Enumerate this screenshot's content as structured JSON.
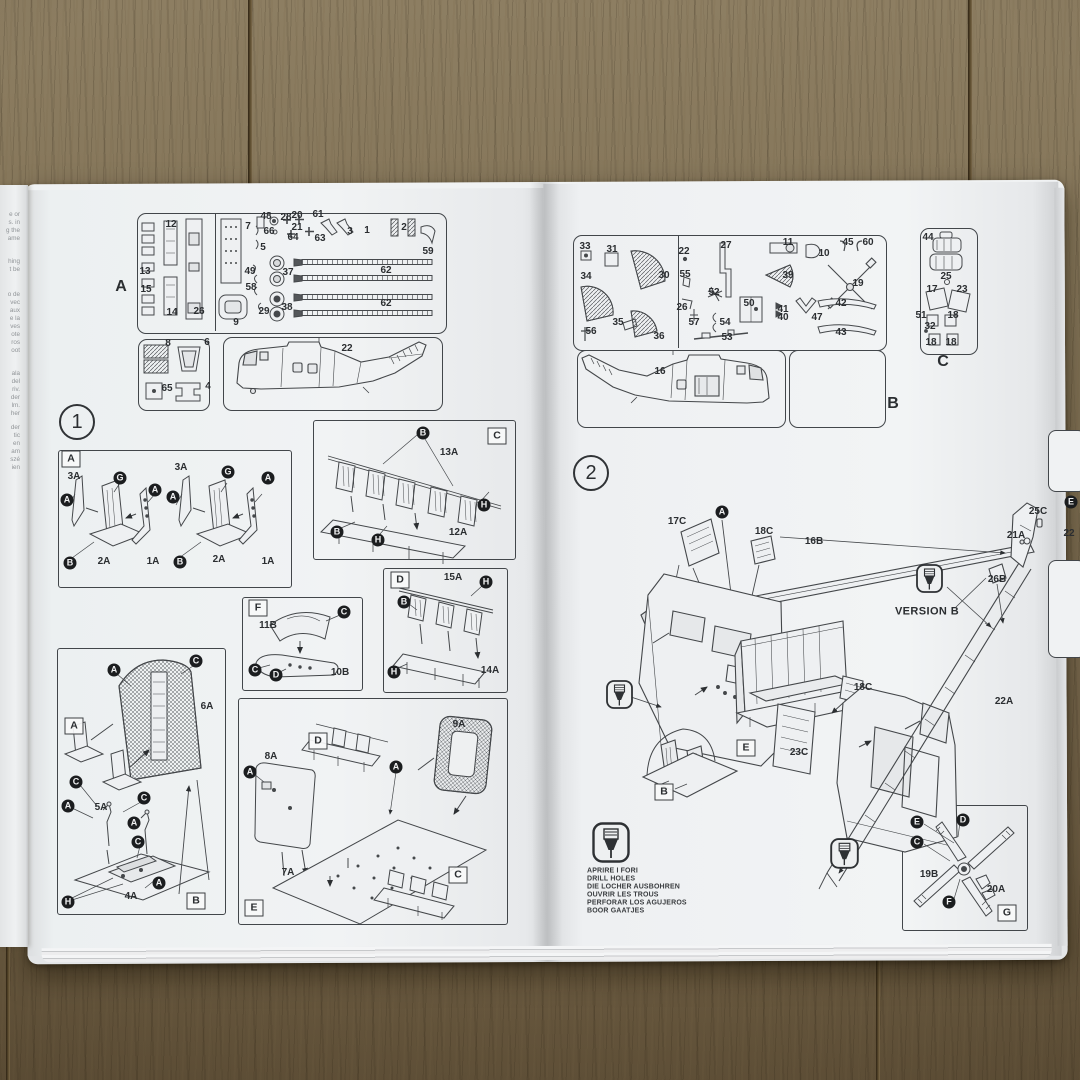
{
  "photo": {
    "wood_color": "#7e6f53",
    "paper_color": "#eef0f2",
    "ink_color": "#33363a"
  },
  "left_margin_text": {
    "fragments": [
      {
        "t": "e or",
        "k": "frag",
        "x": 20,
        "y": 215
      },
      {
        "t": "s. in",
        "k": "frag",
        "x": 20,
        "y": 223
      },
      {
        "t": "g the",
        "k": "frag",
        "x": 20,
        "y": 231
      },
      {
        "t": "ame",
        "k": "frag",
        "x": 20,
        "y": 239
      },
      {
        "t": "hing",
        "k": "frag",
        "x": 20,
        "y": 262
      },
      {
        "t": "t be",
        "k": "frag",
        "x": 20,
        "y": 270
      },
      {
        "t": "o de",
        "k": "frag",
        "x": 20,
        "y": 295
      },
      {
        "t": "vec",
        "k": "frag",
        "x": 20,
        "y": 303
      },
      {
        "t": "aux",
        "k": "frag",
        "x": 20,
        "y": 311
      },
      {
        "t": "e la",
        "k": "frag",
        "x": 20,
        "y": 319
      },
      {
        "t": "ves",
        "k": "frag",
        "x": 20,
        "y": 327
      },
      {
        "t": "ote",
        "k": "frag",
        "x": 20,
        "y": 335
      },
      {
        "t": "ros",
        "k": "frag",
        "x": 20,
        "y": 343
      },
      {
        "t": "oot",
        "k": "frag",
        "x": 20,
        "y": 351
      },
      {
        "t": "ala",
        "k": "frag",
        "x": 20,
        "y": 374
      },
      {
        "t": "del",
        "k": "frag",
        "x": 20,
        "y": 382
      },
      {
        "t": "riv.",
        "k": "frag",
        "x": 20,
        "y": 390
      },
      {
        "t": "der",
        "k": "frag",
        "x": 20,
        "y": 398
      },
      {
        "t": "lm.",
        "k": "frag",
        "x": 20,
        "y": 406
      },
      {
        "t": "her",
        "k": "frag",
        "x": 20,
        "y": 414
      },
      {
        "t": "der",
        "k": "frag",
        "x": 20,
        "y": 428
      },
      {
        "t": "tic",
        "k": "frag",
        "x": 20,
        "y": 436
      },
      {
        "t": "en",
        "k": "frag",
        "x": 20,
        "y": 444
      },
      {
        "t": "am",
        "k": "frag",
        "x": 20,
        "y": 452
      },
      {
        "t": "szé",
        "k": "frag",
        "x": 20,
        "y": 460
      },
      {
        "t": "ien",
        "k": "frag",
        "x": 20,
        "y": 468
      }
    ]
  },
  "left_page": {
    "sprue_panel": {
      "sheet_letter": "A",
      "labels": [
        {
          "t": "A",
          "k": "b",
          "x": 121,
          "y": 287
        },
        {
          "t": "12",
          "x": 171,
          "y": 225
        },
        {
          "t": "13",
          "x": 145,
          "y": 272
        },
        {
          "t": "15",
          "x": 146,
          "y": 290
        },
        {
          "t": "14",
          "x": 172,
          "y": 313
        },
        {
          "t": "26",
          "x": 199,
          "y": 312
        },
        {
          "t": "7",
          "x": 248,
          "y": 227
        },
        {
          "t": "48",
          "x": 266,
          "y": 217
        },
        {
          "t": "28",
          "x": 286,
          "y": 218
        },
        {
          "t": "20",
          "x": 297,
          "y": 216
        },
        {
          "t": "61",
          "x": 318,
          "y": 215
        },
        {
          "t": "66",
          "x": 269,
          "y": 232
        },
        {
          "t": "21",
          "x": 297,
          "y": 228
        },
        {
          "t": "64",
          "x": 293,
          "y": 238
        },
        {
          "t": "63",
          "x": 320,
          "y": 239
        },
        {
          "t": "3",
          "x": 350,
          "y": 232
        },
        {
          "t": "1",
          "x": 367,
          "y": 231
        },
        {
          "t": "2",
          "x": 404,
          "y": 228
        },
        {
          "t": "59",
          "x": 428,
          "y": 252
        },
        {
          "t": "5",
          "x": 263,
          "y": 248
        },
        {
          "t": "49",
          "x": 250,
          "y": 272
        },
        {
          "t": "37",
          "x": 288,
          "y": 273
        },
        {
          "t": "58",
          "x": 251,
          "y": 288
        },
        {
          "t": "38",
          "x": 287,
          "y": 308
        },
        {
          "t": "29",
          "x": 264,
          "y": 312
        },
        {
          "t": "9",
          "x": 236,
          "y": 323
        },
        {
          "t": "62",
          "x": 386,
          "y": 271
        },
        {
          "t": "62",
          "x": 386,
          "y": 304
        },
        {
          "t": "8",
          "x": 168,
          "y": 344
        },
        {
          "t": "6",
          "x": 207,
          "y": 343
        },
        {
          "t": "65",
          "x": 167,
          "y": 389
        },
        {
          "t": "4",
          "x": 208,
          "y": 387
        },
        {
          "t": "22",
          "x": 347,
          "y": 349
        }
      ]
    },
    "step1": {
      "labels": [
        {
          "t": "1",
          "k": "step",
          "x": 77,
          "y": 422
        }
      ]
    },
    "sections": {
      "a": {
        "labels": [
          {
            "t": "A",
            "k": "s",
            "x": 71,
            "y": 459
          },
          {
            "t": "3A",
            "x": 74,
            "y": 477
          },
          {
            "t": "A",
            "k": "c",
            "x": 67,
            "y": 500
          },
          {
            "t": "G",
            "k": "c",
            "x": 120,
            "y": 478
          },
          {
            "t": "A",
            "k": "c",
            "x": 155,
            "y": 490
          },
          {
            "t": "B",
            "k": "c",
            "x": 70,
            "y": 563
          },
          {
            "t": "2A",
            "x": 104,
            "y": 562
          },
          {
            "t": "1A",
            "x": 153,
            "y": 562
          },
          {
            "t": "3A",
            "x": 181,
            "y": 468
          },
          {
            "t": "A",
            "k": "c",
            "x": 173,
            "y": 497
          },
          {
            "t": "G",
            "k": "c",
            "x": 228,
            "y": 472
          },
          {
            "t": "A",
            "k": "c",
            "x": 268,
            "y": 478
          },
          {
            "t": "B",
            "k": "c",
            "x": 180,
            "y": 562
          },
          {
            "t": "2A",
            "x": 219,
            "y": 560
          },
          {
            "t": "1A",
            "x": 268,
            "y": 562
          }
        ]
      },
      "c": {
        "labels": [
          {
            "t": "C",
            "k": "s",
            "x": 497,
            "y": 436
          },
          {
            "t": "B",
            "k": "c",
            "x": 423,
            "y": 433
          },
          {
            "t": "13A",
            "x": 449,
            "y": 453
          },
          {
            "t": "H",
            "k": "c",
            "x": 484,
            "y": 505
          },
          {
            "t": "B",
            "k": "c",
            "x": 337,
            "y": 532
          },
          {
            "t": "H",
            "k": "c",
            "x": 378,
            "y": 540
          },
          {
            "t": "12A",
            "x": 458,
            "y": 533
          }
        ]
      },
      "f": {
        "labels": [
          {
            "t": "F",
            "k": "s",
            "x": 258,
            "y": 608
          },
          {
            "t": "11B",
            "x": 268,
            "y": 626
          },
          {
            "t": "C",
            "k": "c",
            "x": 344,
            "y": 612
          },
          {
            "t": "C",
            "k": "c",
            "x": 255,
            "y": 670
          },
          {
            "t": "D",
            "k": "c",
            "x": 276,
            "y": 675
          },
          {
            "t": "10B",
            "x": 340,
            "y": 673
          }
        ]
      },
      "d": {
        "labels": [
          {
            "t": "D",
            "k": "s",
            "x": 400,
            "y": 580
          },
          {
            "t": "15A",
            "x": 453,
            "y": 578
          },
          {
            "t": "H",
            "k": "c",
            "x": 486,
            "y": 582
          },
          {
            "t": "B",
            "k": "c",
            "x": 404,
            "y": 602
          },
          {
            "t": "H",
            "k": "c",
            "x": 394,
            "y": 672
          },
          {
            "t": "14A",
            "x": 490,
            "y": 671
          }
        ]
      },
      "b": {
        "labels": [
          {
            "t": "A",
            "k": "s",
            "x": 74,
            "y": 726
          },
          {
            "t": "A",
            "k": "c",
            "x": 114,
            "y": 670
          },
          {
            "t": "C",
            "k": "c",
            "x": 196,
            "y": 661
          },
          {
            "t": "6A",
            "x": 207,
            "y": 707
          },
          {
            "t": "C",
            "k": "c",
            "x": 76,
            "y": 782
          },
          {
            "t": "A",
            "k": "c",
            "x": 68,
            "y": 806
          },
          {
            "t": "5A",
            "x": 101,
            "y": 808
          },
          {
            "t": "C",
            "k": "c",
            "x": 144,
            "y": 798
          },
          {
            "t": "A",
            "k": "c",
            "x": 134,
            "y": 823
          },
          {
            "t": "C",
            "k": "c",
            "x": 138,
            "y": 842
          },
          {
            "t": "A",
            "k": "c",
            "x": 159,
            "y": 883
          },
          {
            "t": "4A",
            "x": 131,
            "y": 897
          },
          {
            "t": "H",
            "k": "c",
            "x": 68,
            "y": 902
          },
          {
            "t": "B",
            "k": "s",
            "x": 196,
            "y": 901
          }
        ]
      },
      "e": {
        "labels": [
          {
            "t": "D",
            "k": "s",
            "x": 318,
            "y": 741
          },
          {
            "t": "9A",
            "x": 459,
            "y": 725
          },
          {
            "t": "8A",
            "x": 271,
            "y": 757
          },
          {
            "t": "A",
            "k": "c",
            "x": 250,
            "y": 772
          },
          {
            "t": "A",
            "k": "c",
            "x": 396,
            "y": 767
          },
          {
            "t": "7A",
            "x": 288,
            "y": 873
          },
          {
            "t": "C",
            "k": "s",
            "x": 458,
            "y": 875
          },
          {
            "t": "E",
            "k": "s",
            "x": 254,
            "y": 908
          }
        ]
      }
    }
  },
  "right_page": {
    "sprue_panel_b": {
      "sheet_letter": "B",
      "labels": [
        {
          "t": "B",
          "k": "b",
          "x": 893,
          "y": 404
        },
        {
          "t": "33",
          "x": 585,
          "y": 247
        },
        {
          "t": "31",
          "x": 612,
          "y": 250
        },
        {
          "t": "30",
          "x": 664,
          "y": 276
        },
        {
          "t": "34",
          "x": 586,
          "y": 277
        },
        {
          "t": "35",
          "x": 618,
          "y": 323
        },
        {
          "t": "56",
          "x": 591,
          "y": 332
        },
        {
          "t": "36",
          "x": 659,
          "y": 337
        },
        {
          "t": "22",
          "x": 684,
          "y": 252
        },
        {
          "t": "27",
          "x": 726,
          "y": 246
        },
        {
          "t": "55",
          "x": 685,
          "y": 275
        },
        {
          "t": "52",
          "x": 714,
          "y": 293
        },
        {
          "t": "26",
          "x": 682,
          "y": 308
        },
        {
          "t": "57",
          "x": 694,
          "y": 323
        },
        {
          "t": "54",
          "x": 725,
          "y": 323
        },
        {
          "t": "53",
          "x": 727,
          "y": 338
        },
        {
          "t": "50",
          "x": 749,
          "y": 304
        },
        {
          "t": "11",
          "x": 788,
          "y": 243
        },
        {
          "t": "10",
          "x": 824,
          "y": 254
        },
        {
          "t": "39",
          "x": 788,
          "y": 276
        },
        {
          "t": "41",
          "x": 783,
          "y": 310
        },
        {
          "t": "40",
          "x": 783,
          "y": 318
        },
        {
          "t": "47",
          "x": 817,
          "y": 318
        },
        {
          "t": "19",
          "x": 858,
          "y": 284
        },
        {
          "t": "45",
          "x": 848,
          "y": 243
        },
        {
          "t": "60",
          "x": 868,
          "y": 243
        },
        {
          "t": "42",
          "x": 841,
          "y": 304
        },
        {
          "t": "43",
          "x": 841,
          "y": 333
        },
        {
          "t": "16",
          "x": 660,
          "y": 372
        }
      ]
    },
    "sprue_panel_c": {
      "sheet_letter": "C",
      "labels": [
        {
          "t": "C",
          "k": "b",
          "x": 943,
          "y": 362
        },
        {
          "t": "44",
          "x": 928,
          "y": 238
        },
        {
          "t": "25",
          "x": 946,
          "y": 277
        },
        {
          "t": "17",
          "x": 932,
          "y": 290
        },
        {
          "t": "23",
          "x": 962,
          "y": 290
        },
        {
          "t": "51",
          "x": 921,
          "y": 316
        },
        {
          "t": "18",
          "x": 953,
          "y": 316
        },
        {
          "t": "32",
          "x": 930,
          "y": 327
        },
        {
          "t": "18",
          "x": 931,
          "y": 343
        },
        {
          "t": "18",
          "x": 951,
          "y": 343
        }
      ]
    },
    "step2": {
      "version_note": "VERSION B",
      "labels": [
        {
          "t": "2",
          "k": "step",
          "x": 591,
          "y": 473
        },
        {
          "t": "17C",
          "x": 677,
          "y": 522
        },
        {
          "t": "A",
          "k": "c",
          "x": 722,
          "y": 512
        },
        {
          "t": "18C",
          "x": 764,
          "y": 532
        },
        {
          "t": "16B",
          "x": 814,
          "y": 542
        },
        {
          "t": "25C",
          "x": 1038,
          "y": 512
        },
        {
          "t": "21A",
          "x": 1016,
          "y": 536
        },
        {
          "t": "26B",
          "x": 997,
          "y": 580
        },
        {
          "t": "VERSION B",
          "k": "v",
          "x": 927,
          "y": 612
        },
        {
          "t": "18C",
          "x": 863,
          "y": 688
        },
        {
          "t": "23C",
          "x": 799,
          "y": 753
        },
        {
          "t": "E",
          "k": "s",
          "x": 746,
          "y": 748
        },
        {
          "t": "B",
          "k": "s",
          "x": 664,
          "y": 792
        },
        {
          "t": "22A",
          "x": 1004,
          "y": 702
        },
        {
          "t": "E",
          "k": "c",
          "x": 1071,
          "y": 502
        },
        {
          "t": "22",
          "x": 1069,
          "y": 534
        }
      ]
    },
    "drill_legend": {
      "lines": [
        "APRIRE I FORI",
        "DRILL HOLES",
        "DIE LOCHER AUSBOHREN",
        "OUVRIR LES TROUS",
        "PERFORAR LOS AGUJEROS",
        "BOOR GAATJES"
      ],
      "labels": [
        {
          "t": "APRIRE I FORI",
          "k": "dl",
          "x": 587,
          "y": 871
        },
        {
          "t": "DRILL HOLES",
          "k": "dl",
          "x": 587,
          "y": 879
        },
        {
          "t": "DIE LOCHER AUSBOHREN",
          "k": "dl",
          "x": 587,
          "y": 887
        },
        {
          "t": "OUVRIR LES TROUS",
          "k": "dl",
          "x": 587,
          "y": 895
        },
        {
          "t": "PERFORAR LOS AGUJEROS",
          "k": "dl",
          "x": 587,
          "y": 903
        },
        {
          "t": "BOOR GAATJES",
          "k": "dl",
          "x": 587,
          "y": 911
        }
      ]
    },
    "section_g": {
      "labels": [
        {
          "t": "E",
          "k": "c",
          "x": 917,
          "y": 822
        },
        {
          "t": "D",
          "k": "c",
          "x": 963,
          "y": 820
        },
        {
          "t": "C",
          "k": "c",
          "x": 917,
          "y": 842
        },
        {
          "t": "19B",
          "x": 929,
          "y": 875
        },
        {
          "t": "F",
          "k": "c",
          "x": 949,
          "y": 902
        },
        {
          "t": "20A",
          "x": 996,
          "y": 890
        },
        {
          "t": "G",
          "k": "s",
          "x": 1007,
          "y": 913
        }
      ]
    }
  }
}
